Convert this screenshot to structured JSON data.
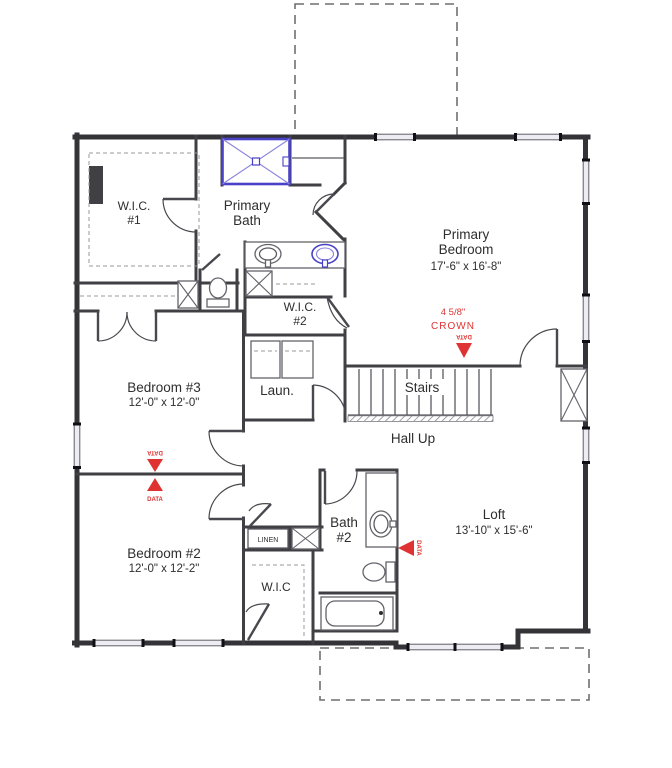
{
  "rooms": {
    "wic1": {
      "name": "W.I.C.",
      "number": "#1"
    },
    "primary_bath": {
      "name": "Primary",
      "name2": "Bath"
    },
    "primary_bedroom": {
      "name": "Primary",
      "name2": "Bedroom",
      "dims": "17'-6\" x 16'-8\""
    },
    "wic2": {
      "name": "W.I.C.",
      "number": "#2"
    },
    "bedroom3": {
      "name": "Bedroom #3",
      "dims": "12'-0\" x 12'-0\""
    },
    "laundry": {
      "name": "Laun."
    },
    "stairs": {
      "name": "Stairs"
    },
    "hall": {
      "name": "Hall Up"
    },
    "bedroom2": {
      "name": "Bedroom #2",
      "dims": "12'-0\" x 12'-2\""
    },
    "linen": {
      "name": "LINEN"
    },
    "bath2": {
      "name": "Bath",
      "number": "#2"
    },
    "wic3": {
      "name": "W.I.C"
    },
    "loft": {
      "name": "Loft",
      "dims": "13'-10\" x 15'-6\""
    }
  },
  "annotations": {
    "crown_size": "4 5/8\"",
    "crown_label": "CROWN",
    "data_label": "DATA"
  },
  "colors": {
    "wall": "#333338",
    "window_fill": "#ececf2",
    "dashed_overhang": "#6f6f6f",
    "shower_blue": "#4a42c6",
    "annotation_red": "#df3333",
    "text": "#2e2e2e"
  }
}
